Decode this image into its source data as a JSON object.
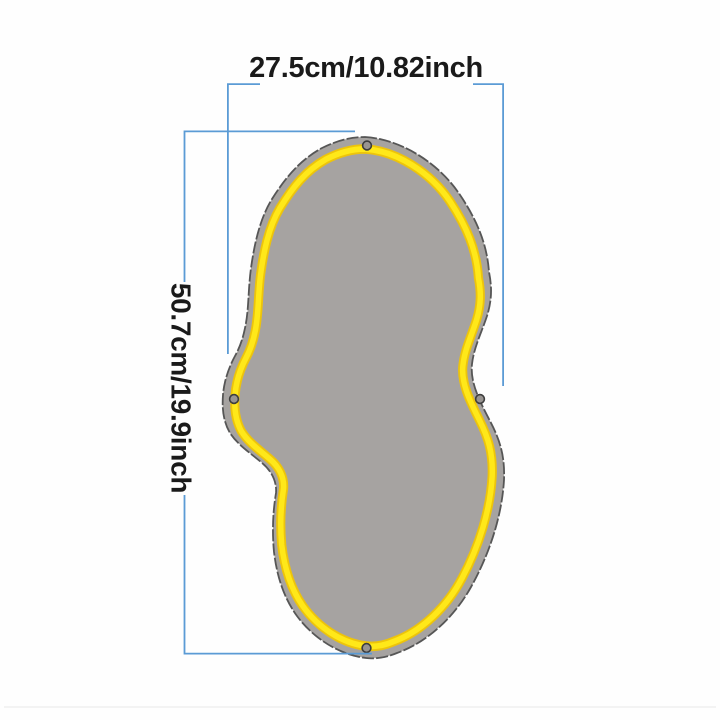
{
  "dimensions": {
    "width_label": "27.5cm/10.82inch",
    "height_label": "50.7cm/19.9inch"
  },
  "mirror": {
    "shape": "irregular-cloud",
    "mount_hole_count": 4
  },
  "colors": {
    "dimension_line": "#5b9bd5",
    "label_text": "#1a1a1a",
    "mirror_fill": "#a6a3a1",
    "mirror_edge": "#565656",
    "neon_core": "#ffe819",
    "neon_edge": "#edc40b",
    "hole_fill": "#989491",
    "hole_ring": "#3d3d3d",
    "page_edge": "#efefef"
  }
}
